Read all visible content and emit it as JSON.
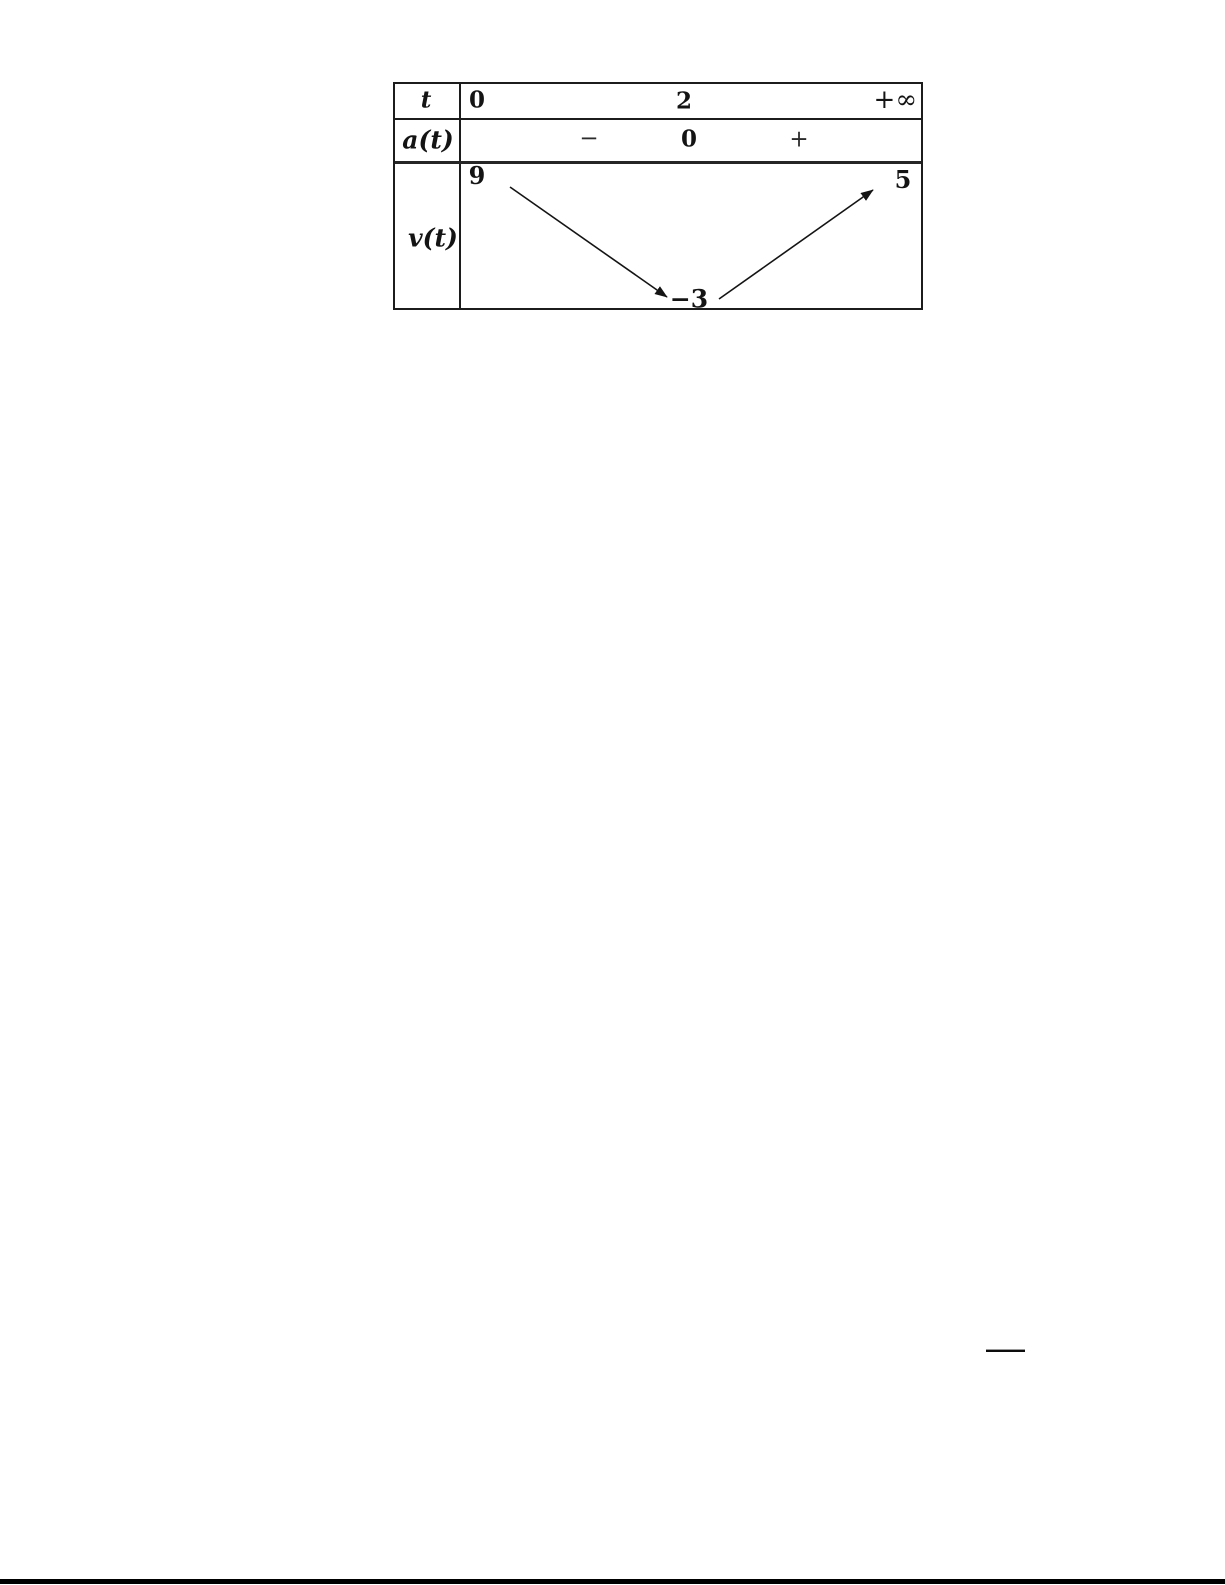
{
  "variation_table": {
    "header_row": {
      "variable": "t",
      "t_start": "0",
      "t_critical": "2",
      "t_end": "+∞"
    },
    "sign_row": {
      "label": "a(t)",
      "sign_before": "−",
      "zero": "0",
      "sign_after": "+"
    },
    "value_row": {
      "label": "v(t)",
      "value_at_0": "9",
      "value_at_2": "−3",
      "value_at_infinity": "5",
      "variations": [
        {
          "interval": "[0, 2]",
          "direction": "decreasing",
          "from": 9,
          "to": -3
        },
        {
          "interval": "[2, +∞)",
          "direction": "increasing",
          "from": -3,
          "to": 5
        }
      ]
    },
    "ink_color": "#141414",
    "border_color": "#1c1c1c"
  }
}
